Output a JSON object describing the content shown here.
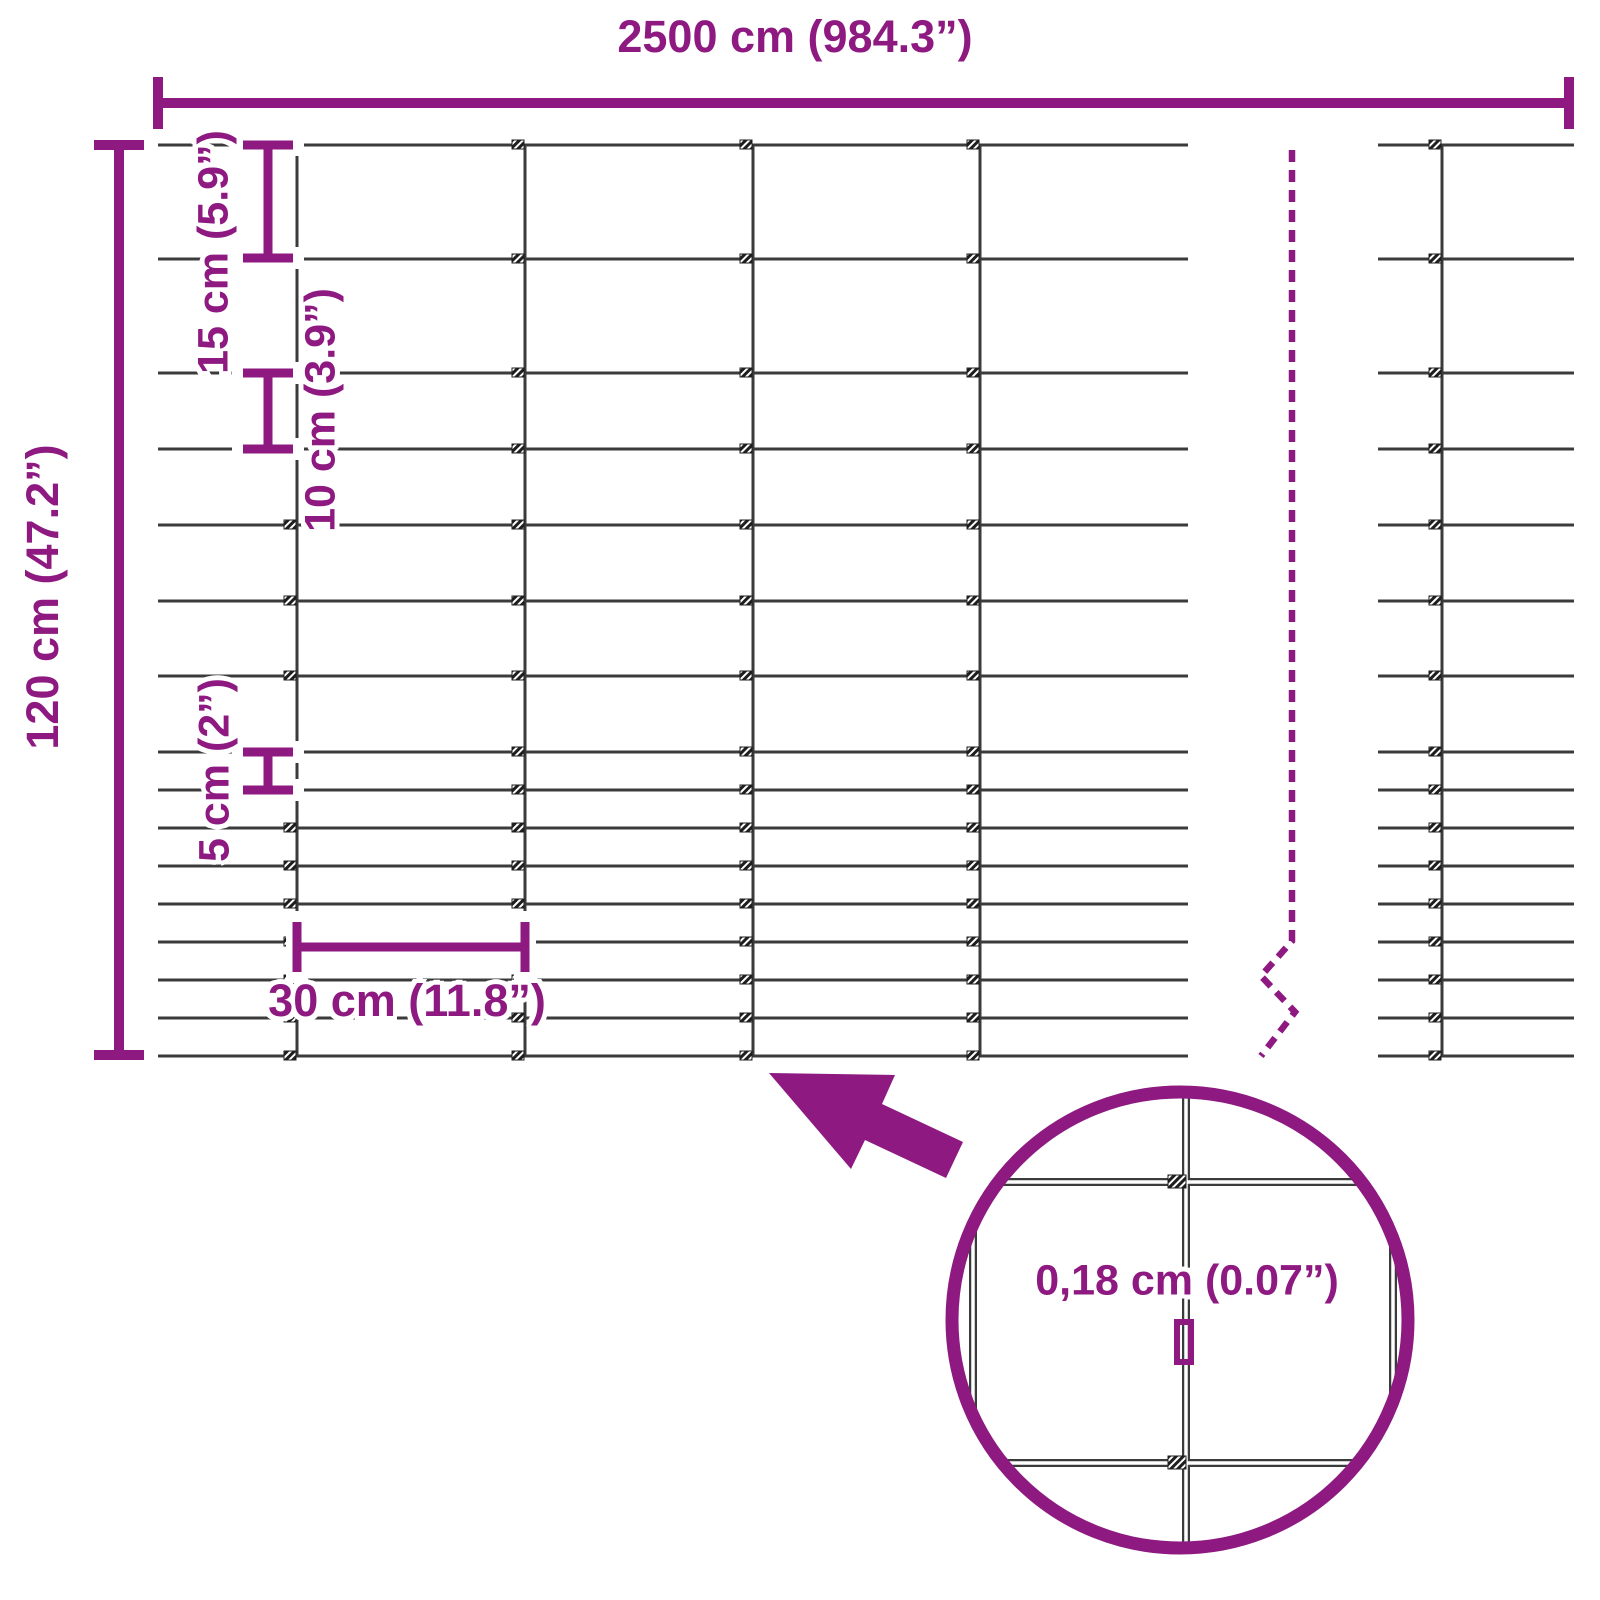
{
  "title": "Wire mesh fence dimension diagram",
  "colors": {
    "accent": "#8D1981",
    "wire": "#3B3B3B",
    "background": "#FFFFFF"
  },
  "labels": {
    "total_length": "2500 cm (984.3”)",
    "height": "120 cm (47.2”)",
    "gap_15": "15 cm (5.9”)",
    "gap_10": "10 cm (3.9”)",
    "gap_5": "5 cm (2”)",
    "mesh_width": "30 cm (11.8”)",
    "wire_thickness": "0,18 cm (0.07”)"
  },
  "structure": {
    "total_length_cm": 2500,
    "total_height_cm": 120,
    "row_gaps_cm": [
      15,
      15,
      10,
      10,
      10,
      10,
      10,
      5,
      5,
      5,
      5,
      5,
      5,
      5,
      5
    ],
    "column_spacing_cm": 30,
    "wire_thickness_cm": 0.18
  }
}
